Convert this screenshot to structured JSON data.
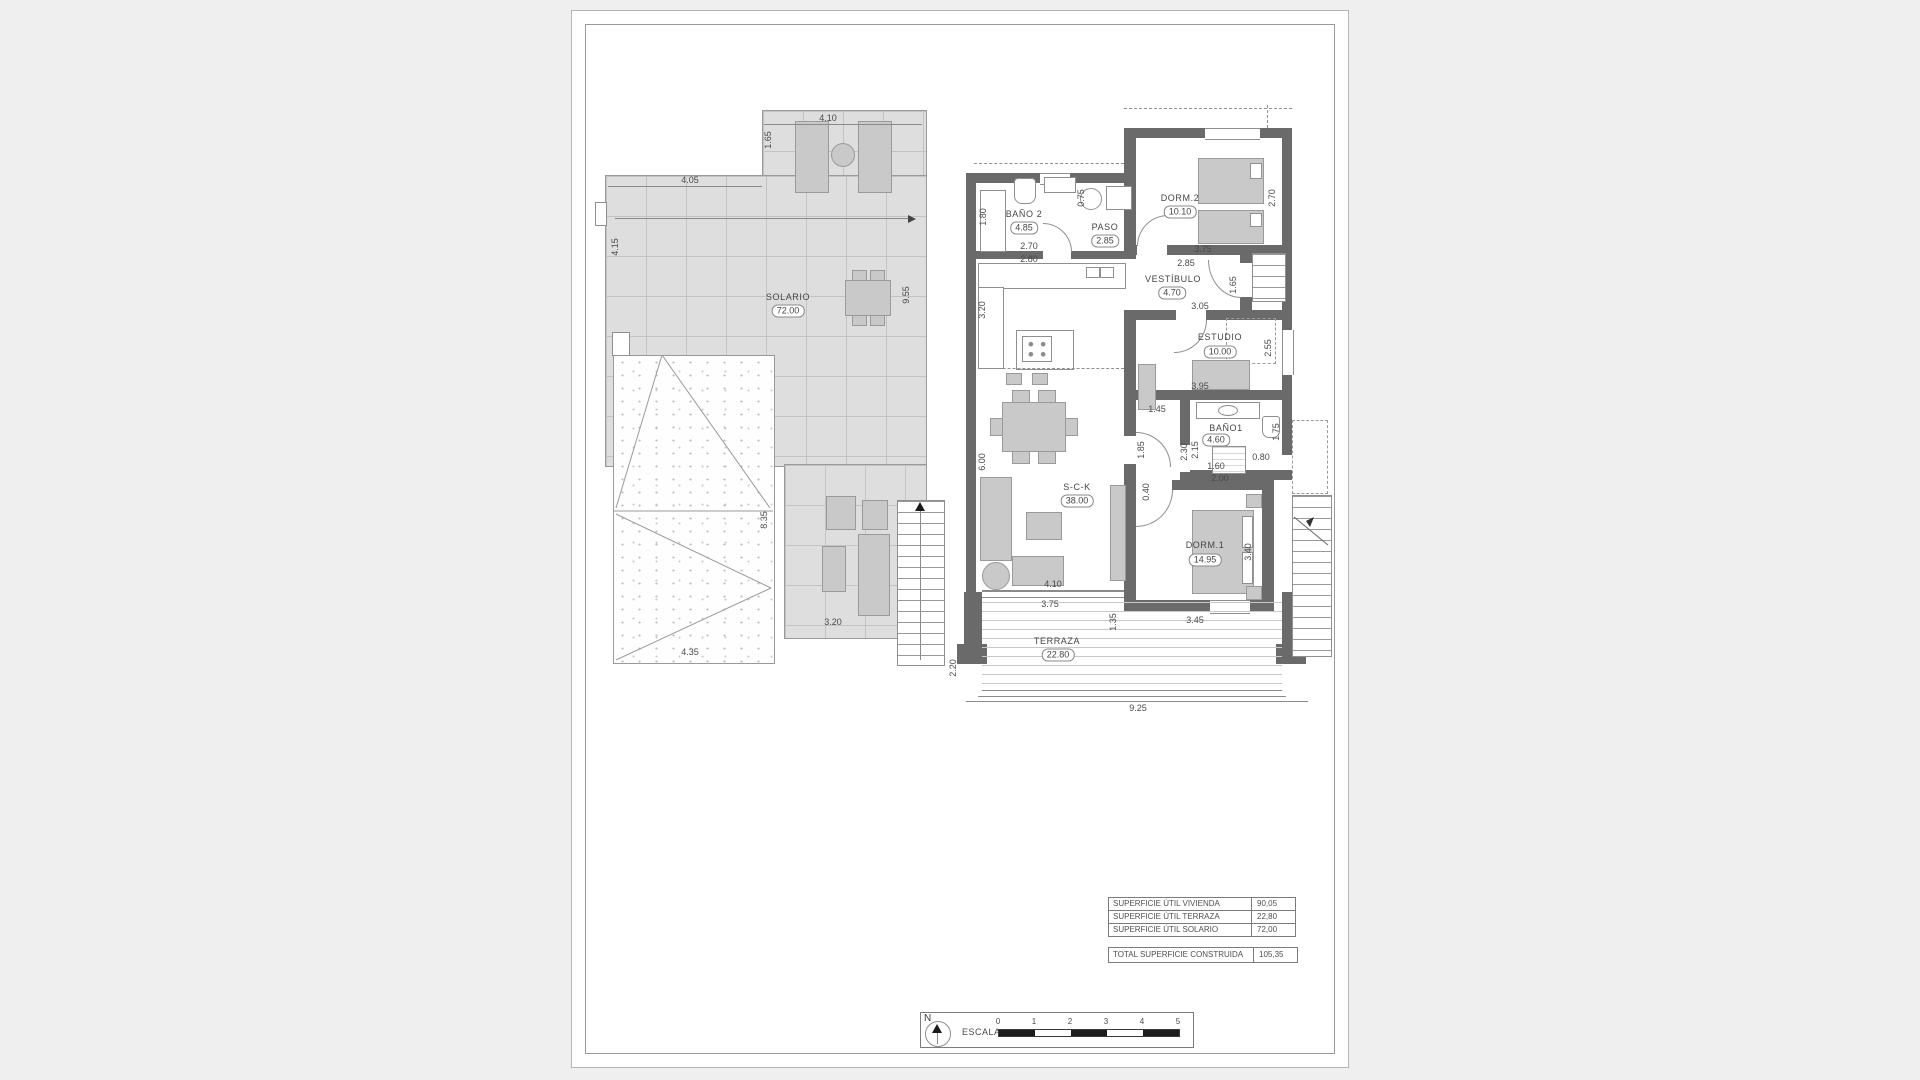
{
  "left_plan": {
    "room_label": "SOLARIO",
    "room_area": "72.00",
    "dims": {
      "top": "4.10",
      "top_left_v": "1.65",
      "upper": "4.05",
      "left_v": "4.15",
      "right_v": "9.55",
      "roof_v": "8.35",
      "roof_bottom": "4.35",
      "lower": "3.20"
    }
  },
  "right_plan": {
    "rooms": {
      "banio2": {
        "label": "BAÑO 2",
        "area": "4.85"
      },
      "paso": {
        "label": "PASO",
        "area": "2.85"
      },
      "dorm2": {
        "label": "DORM.2",
        "area": "10.10"
      },
      "vestibulo": {
        "label": "VESTÍBULO",
        "area": "4.70"
      },
      "estudio": {
        "label": "ESTUDIO",
        "area": "10.00"
      },
      "banio1": {
        "label": "BAÑO1",
        "area": "4.60"
      },
      "dorm1": {
        "label": "DORM.1",
        "area": "14.95"
      },
      "sck": {
        "label": "S-C-K",
        "area": "38.00"
      },
      "terraza": {
        "label": "TERRAZA",
        "area": "22.80"
      }
    },
    "dims": {
      "banio2_left_v": "1.80",
      "banio2_w1": "2.70",
      "banio2_w2": "2.80",
      "paso_v": "0.75",
      "dorm2_right_v": "2.70",
      "dorm2_w": "3.75",
      "vest_top": "2.85",
      "vest_bottom": "3.05",
      "vest_right_v": "1.65",
      "sck_left_upper_v": "3.20",
      "sck_left_lower_v": "6.00",
      "estudio_right_v": "2.55",
      "estudio_w": "3.95",
      "hall_w": "1.45",
      "hall_v": "1.85",
      "col_v": "0.40",
      "banio1_left_a_v": "2.30",
      "banio1_left_b_v": "2.15",
      "banio1_w": "1.60",
      "banio1_w2": "2.00",
      "banio1_step": "0.80",
      "banio1_right_v": "1.75",
      "dorm1_right_v": "3.40",
      "dorm1_w": "3.45",
      "sofa_w": "4.10",
      "terraza_top": "3.75",
      "terraza_right_v": "1.35",
      "terraza_left_v": "2.20",
      "bottom": "9.25"
    }
  },
  "summary_table": {
    "rows": [
      {
        "label": "SUPERFICIE ÚTIL VIVIENDA",
        "value": "90,05"
      },
      {
        "label": "SUPERFICIE ÚTIL TERRAZA",
        "value": "22,80"
      },
      {
        "label": "SUPERFICIE ÚTIL SOLARIO",
        "value": "72,00"
      }
    ],
    "total_label": "TOTAL SUPERFICIE CONSTRUIDA",
    "total_value": "105,35"
  },
  "scale_bar": {
    "label": "ESCALA :",
    "ticks": [
      "0",
      "1",
      "2",
      "3",
      "4",
      "5"
    ]
  },
  "compass": {
    "label": "N"
  },
  "colors": {
    "wall": "#6a6a6a",
    "furniture": "#c9c9c9",
    "tiles": "#dedede",
    "sheet": "#ffffff",
    "page_bg": "#efefef"
  }
}
